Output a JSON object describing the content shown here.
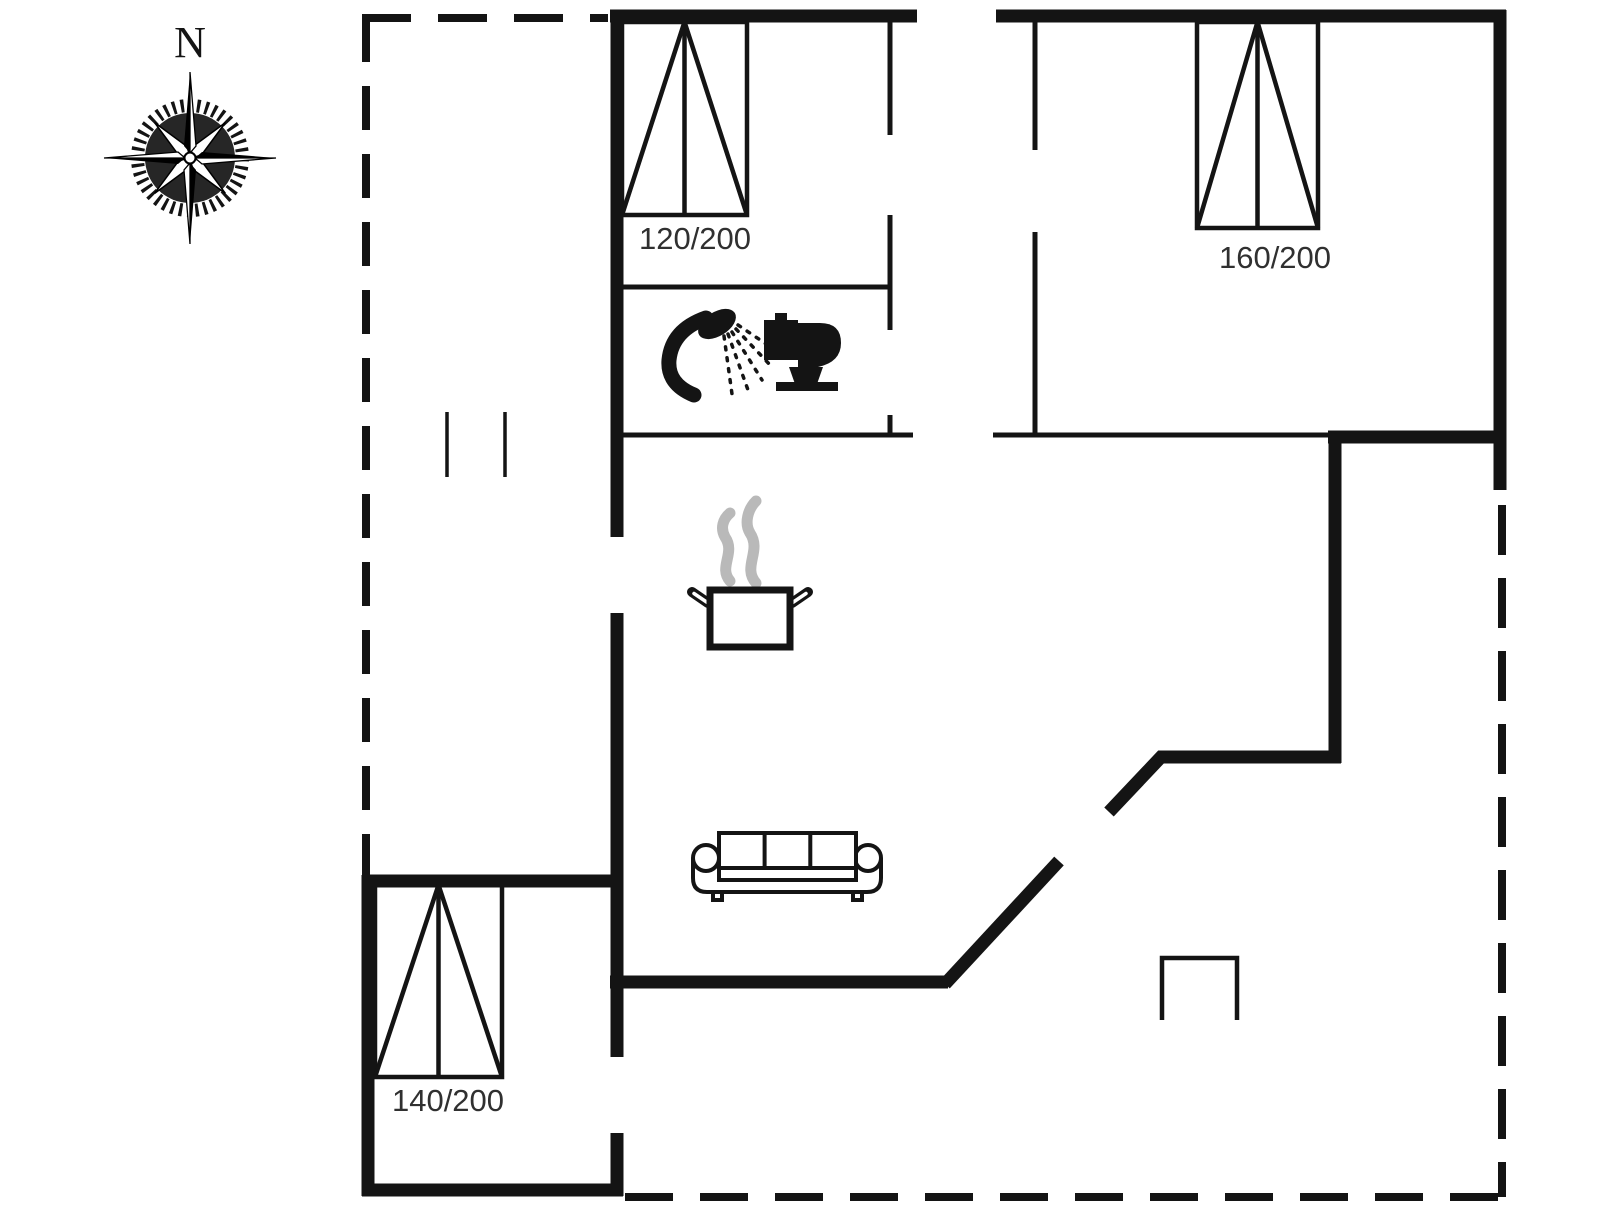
{
  "plan": {
    "compass": {
      "label": "N"
    },
    "rooms": {
      "bedroom_top_left": {
        "bed_label": "120/200"
      },
      "bedroom_top_right": {
        "bed_label": "160/200"
      },
      "bedroom_bottom_left": {
        "bed_label": "140/200"
      }
    },
    "icons": {
      "compass": "compass-rose-icon",
      "shower": "shower-icon",
      "toilet": "toilet-icon",
      "stove": "cooking-pot-icon",
      "sofa": "sofa-icon",
      "chimney": "chimney-outline"
    },
    "colors": {
      "wall": "#141414",
      "steam": "#b9b9b9",
      "label_text": "#303030",
      "background": "#ffffff"
    }
  }
}
